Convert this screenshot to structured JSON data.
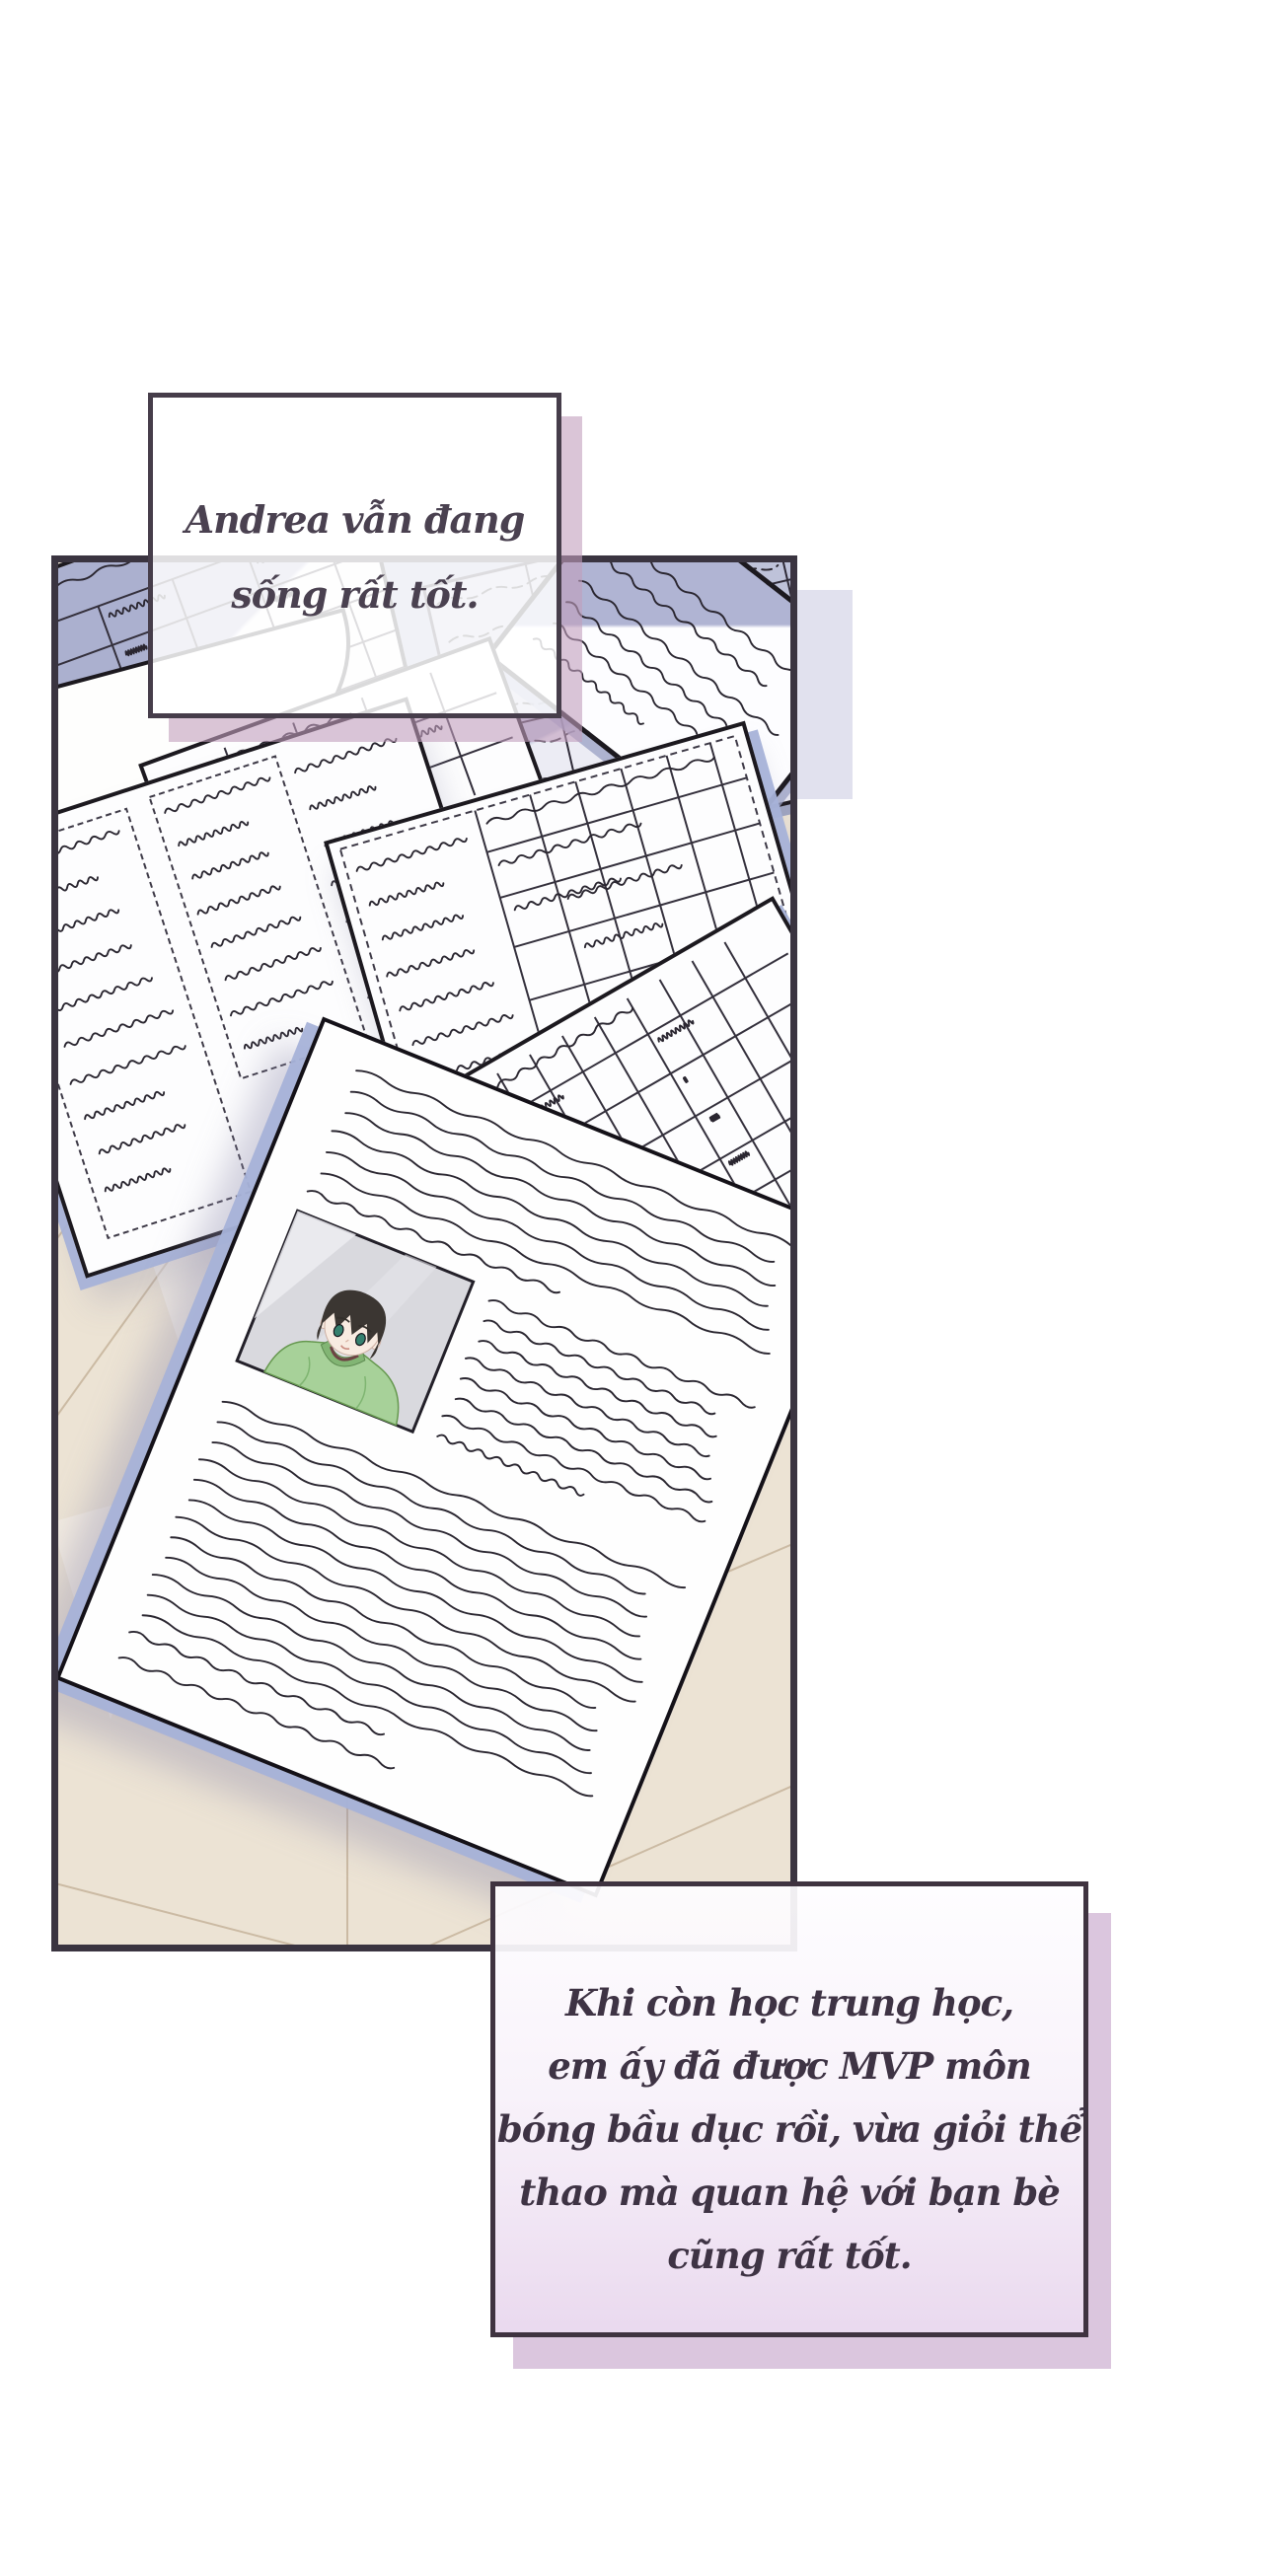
{
  "speech": {
    "top": {
      "lines": [
        "Andrea vẫn đang",
        "sống rất tốt."
      ]
    },
    "bottom": {
      "lines": [
        "Khi còn học trung học,",
        "em ấy đã được MVP môn",
        "bóng bầu dục rồi, vừa giỏi thể",
        "thao mà quan hệ với bạn bè",
        "cũng rất tốt."
      ]
    }
  },
  "colors": {
    "background": "#ffffff",
    "panel_border": "#3a3440",
    "bubble_border": "#463d4a",
    "bubble_shadow_mauve": "#c19ebd",
    "floor_wood": "#ece3d4",
    "floor_line": "#c6b49b",
    "paper_white": "#fdfdfe",
    "paper_shade_periwinkle": "#a9aecd",
    "paper_edge_blue": "#a7b2d8",
    "ink": "#2a2630",
    "speech_text": "#463c4c",
    "photo_hair": "#3b3632",
    "photo_sweater": "#a7d199",
    "photo_skin": "#f8ebe1",
    "photo_eyes": "#35806e"
  }
}
